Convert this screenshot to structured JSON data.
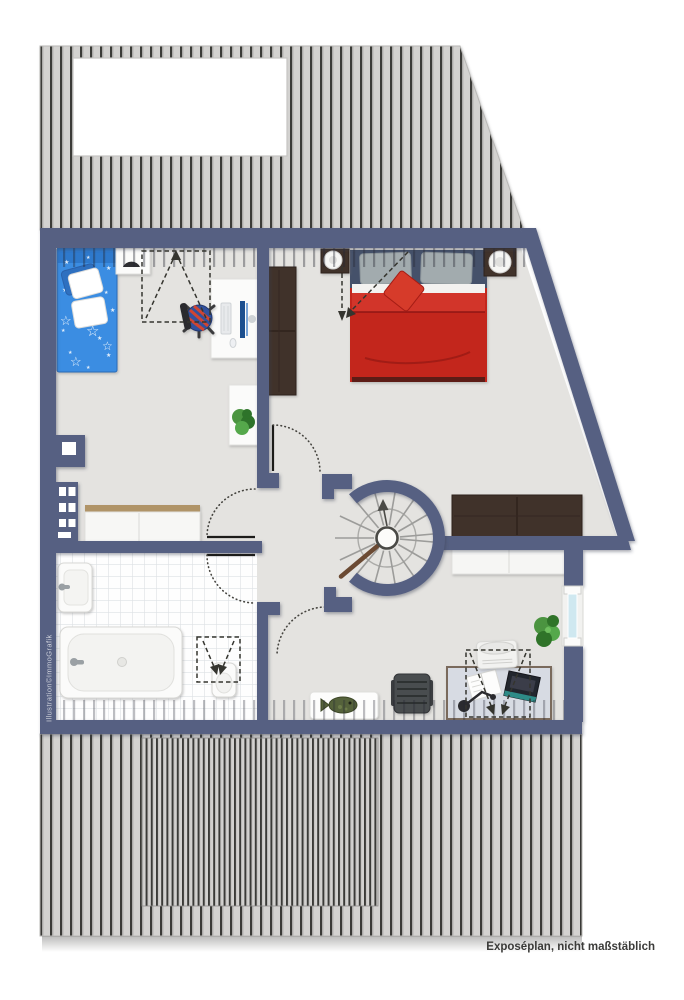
{
  "labels": {
    "watermark": "Illustration©ImmoGrafik",
    "disclaimer": "Exposéplan, nicht maßstäblich"
  },
  "icons": {
    "star_solid": "★",
    "star_outline": "☆"
  },
  "plan": {
    "type": "floor-plan",
    "rooms_rendered": [
      "childrens-room",
      "bedroom",
      "bathroom",
      "stair-landing",
      "study-area"
    ],
    "furniture_rendered": [
      "child-bed",
      "wall-lamp-shelf",
      "kids-desk",
      "desk-chair",
      "plant-shelf",
      "wardrobe",
      "double-bed",
      "nightstand-left",
      "nightstand-right",
      "sideboard-dark",
      "hall-cabinet",
      "chimney-shaft",
      "sink",
      "bathtub",
      "toilet",
      "spiral-staircase",
      "sideboard-white",
      "window",
      "potted-plant",
      "office-desk",
      "office-chair",
      "desk-lamp",
      "laptop",
      "notebook",
      "printer",
      "fish-rug",
      "dormer-markings",
      "door-swings"
    ]
  },
  "colors": {
    "wall": "#566082",
    "roofFill": "#d3d2d0",
    "roofLine": "#3a3a37",
    "roofMid": "#c4c3c1",
    "floor": "#e4e3e0",
    "bathFloor": "#fefefe",
    "tileLine": "#dde1e4",
    "childBed": "#3b8de2",
    "childBedHead": "#2f79cc",
    "childBedEdge": "#2b6cb8",
    "pillowBlue": "#2e6fc0",
    "bedRed": "#c3271b",
    "bedRedFold": "#d2362a",
    "bedCrease": "#93150e",
    "headboard": "#44516b",
    "pillowGray": "#a2abae",
    "cushionRed": "#d63a2c",
    "wood": "#41312a",
    "woodSeam": "#2e231d",
    "woodTop": "#b09468",
    "whiteFurn": "#fbfbfa",
    "furnEdge": "#e2e2df",
    "plantGreen": "#4b9440",
    "plantDark": "#2f7329",
    "stairStep": "#9c9c9a",
    "handrail": "#6b4a33",
    "glass": "#cfe8f0",
    "deskTop": "#d7dbe3",
    "deskEdge": "#7a6a5c",
    "chairGray": "#4a4d50",
    "laptopDark": "#23262e",
    "laptopTeal": "#2e8b87",
    "doorLeaf": "#1c1c1a",
    "dashColor": "#35352f",
    "dotColor": "#45443f",
    "textColor": "#3b3b39",
    "watermark": "#d5d8e0",
    "fishOlive": "#55623a"
  }
}
